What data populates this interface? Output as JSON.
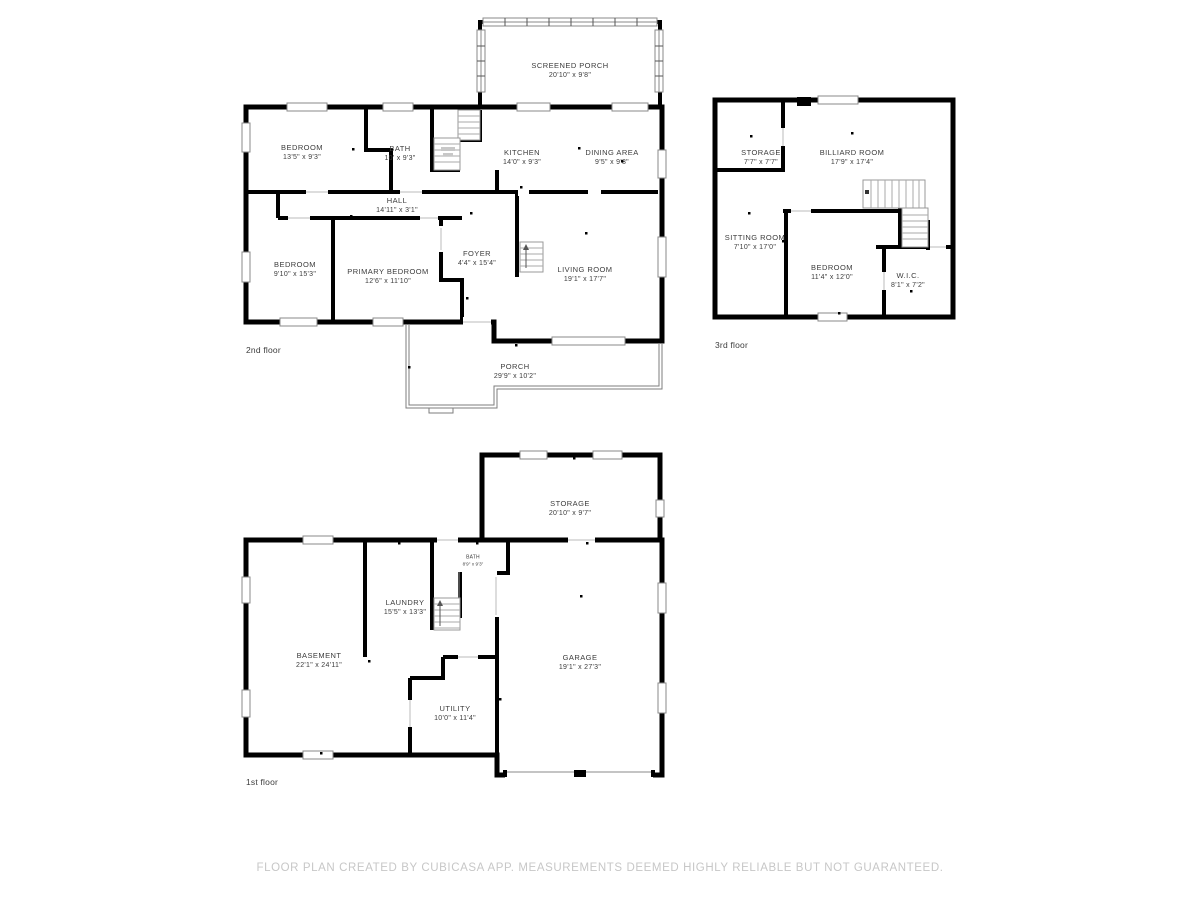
{
  "floors": {
    "second": {
      "label": "2nd floor",
      "rooms": {
        "screened_porch": {
          "name": "SCREENED PORCH",
          "dims": "20'10\" x 9'8\""
        },
        "bedroom_top": {
          "name": "BEDROOM",
          "dims": "13'5\" x 9'3\""
        },
        "bath": {
          "name": "BATH",
          "dims": "10' x 9'3\""
        },
        "kitchen": {
          "name": "KITCHEN",
          "dims": "14'0\" x 9'3\""
        },
        "dining": {
          "name": "DINING AREA",
          "dims": "9'5\" x 9'3\""
        },
        "hall": {
          "name": "HALL",
          "dims": "14'11\" x 3'1\""
        },
        "bedroom_left": {
          "name": "BEDROOM",
          "dims": "9'10\" x 15'3\""
        },
        "primary": {
          "name": "PRIMARY BEDROOM",
          "dims": "12'6\" x 11'10\""
        },
        "foyer": {
          "name": "FOYER",
          "dims": "4'4\" x 15'4\""
        },
        "living": {
          "name": "LIVING ROOM",
          "dims": "19'1\" x 17'7\""
        },
        "porch": {
          "name": "PORCH",
          "dims": "29'9\" x 10'2\""
        }
      }
    },
    "third": {
      "label": "3rd floor",
      "rooms": {
        "storage": {
          "name": "STORAGE",
          "dims": "7'7\" x 7'7\""
        },
        "billiard": {
          "name": "BILLIARD ROOM",
          "dims": "17'9\" x 17'4\""
        },
        "sitting": {
          "name": "SITTING ROOM",
          "dims": "7'10\" x 17'0\""
        },
        "bedroom": {
          "name": "BEDROOM",
          "dims": "11'4\" x 12'0\""
        },
        "wic": {
          "name": "W.I.C.",
          "dims": "8'1\" x 7'2\""
        }
      }
    },
    "first": {
      "label": "1st floor",
      "rooms": {
        "storage": {
          "name": "STORAGE",
          "dims": "20'10\" x 9'7\""
        },
        "bath": {
          "name": "BATH",
          "dims": "8'9\" x 9'3\""
        },
        "laundry": {
          "name": "LAUNDRY",
          "dims": "15'5\" x 13'3\""
        },
        "basement": {
          "name": "BASEMENT",
          "dims": "22'1\" x 24'11\""
        },
        "garage": {
          "name": "GARAGE",
          "dims": "19'1\" x 27'3\""
        },
        "utility": {
          "name": "UTILITY",
          "dims": "10'0\" x 11'4\""
        }
      }
    }
  },
  "footer": {
    "text": "FLOOR PLAN CREATED BY CUBICASA APP. MEASUREMENTS DEEMED HIGHLY RELIABLE BUT NOT GUARANTEED."
  },
  "colors": {
    "wall": "#000000",
    "label_text": "#3c3c3c",
    "footer_text": "#c7c7c7",
    "thin_detail": "#8a8a8a"
  }
}
